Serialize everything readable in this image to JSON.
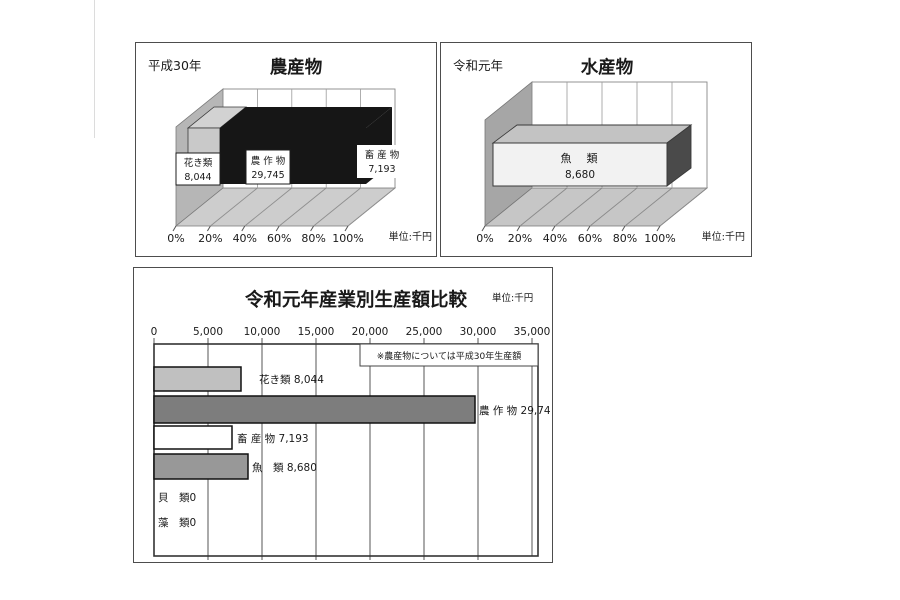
{
  "panels": {
    "nousan": {
      "year": "平成30年",
      "title": "農産物",
      "unit": "単位:千円",
      "x_labels": [
        "0%",
        "20%",
        "40%",
        "60%",
        "80%",
        "100%"
      ],
      "segments": [
        {
          "name": "花き類",
          "value": "8,044"
        },
        {
          "name": "農 作 物",
          "value": "29,745"
        },
        {
          "name": "畜 産 物",
          "value": "7,193"
        }
      ]
    },
    "suisan": {
      "year": "令和元年",
      "title": "水産物",
      "unit": "単位:千円",
      "x_labels": [
        "0%",
        "20%",
        "40%",
        "60%",
        "80%",
        "100%"
      ],
      "segments": [
        {
          "name": "魚　類",
          "value": "8,680"
        }
      ]
    },
    "hikaku": {
      "title": "令和元年産業別生産額比較",
      "unit": "単位:千円",
      "note": "※農産物については平成30年生産額",
      "x_labels": [
        "0",
        "5,000",
        "10,000",
        "15,000",
        "20,000",
        "25,000",
        "30,000",
        "35,000"
      ],
      "rows": [
        {
          "label": "花き類 8,044"
        },
        {
          "label": "農 作 物 29,745"
        },
        {
          "label": "畜 産 物 7,193"
        },
        {
          "label": "魚　類 8,680"
        },
        {
          "label": "貝　類0"
        },
        {
          "label": "藻　類0"
        }
      ]
    }
  },
  "chart_data": [
    {
      "type": "bar",
      "variant": "3d-horizontal-stacked-100pct",
      "title": "農産物",
      "period": "平成30年",
      "unit": "千円",
      "categories": [
        "花き類",
        "農作物",
        "畜産物"
      ],
      "values": [
        8044,
        29745,
        7193
      ],
      "axis_ticks_percent": [
        0,
        20,
        40,
        60,
        80,
        100
      ],
      "series_colors": [
        "#c9c9c9",
        "#161616",
        "#161616"
      ]
    },
    {
      "type": "bar",
      "variant": "3d-horizontal-stacked-100pct",
      "title": "水産物",
      "period": "令和元年",
      "unit": "千円",
      "categories": [
        "魚類"
      ],
      "values": [
        8680
      ],
      "axis_ticks_percent": [
        0,
        20,
        40,
        60,
        80,
        100
      ],
      "series_colors": [
        "#f2f2f2"
      ]
    },
    {
      "type": "bar",
      "variant": "horizontal",
      "title": "令和元年産業別生産額比較",
      "unit": "千円",
      "note": "※農産物については平成30年生産額",
      "categories": [
        "花き類",
        "農作物",
        "畜産物",
        "魚類",
        "貝類",
        "藻類"
      ],
      "values": [
        8044,
        29745,
        7193,
        8680,
        0,
        0
      ],
      "xlim": [
        0,
        35000
      ],
      "x_ticks": [
        0,
        5000,
        10000,
        15000,
        20000,
        25000,
        30000,
        35000
      ],
      "grid": true,
      "bar_colors": [
        "#c0c0c0",
        "#7d7d7d",
        "#ffffff",
        "#989898",
        null,
        null
      ]
    }
  ],
  "colors": {
    "panel_border": "#4d4d4d",
    "wall_left": "#b6b6b6",
    "floor": "#cdcdcd",
    "bar_black": "#161616",
    "bar_light": "#c9c9c9",
    "bar_white": "#f2f2f2"
  }
}
